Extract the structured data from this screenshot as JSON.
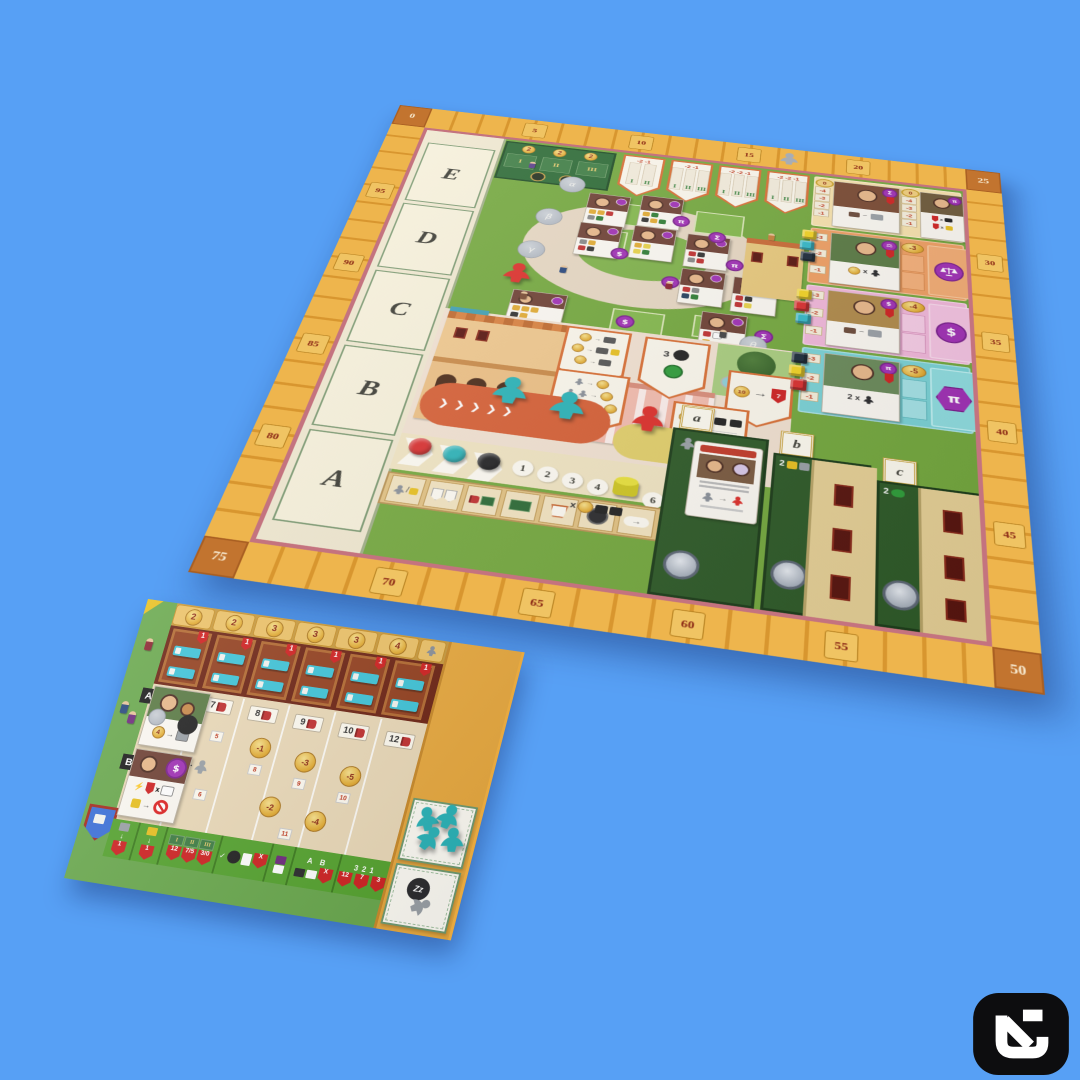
{
  "scene": {
    "background_color": "#57a0f5",
    "description": "board game tabletop product photo on blue backdrop"
  },
  "logo": {
    "icon": "un-monogram",
    "color": "#0d0d0f"
  },
  "main_board": {
    "track": {
      "corners": [
        "0",
        "25",
        "50",
        "75"
      ],
      "top": [
        "5",
        "10",
        "15",
        "20"
      ],
      "right": [
        "30",
        "35",
        "40",
        "45"
      ],
      "bottom": [
        "70",
        "65",
        "60",
        "55"
      ],
      "left": [
        "95",
        "90",
        "85",
        "80"
      ]
    },
    "book_slots": [
      "E",
      "D",
      "C",
      "B",
      "A"
    ],
    "setup_table": {
      "coins": [
        "2",
        "2",
        "2"
      ],
      "tiers": [
        "I",
        "II",
        "III"
      ]
    },
    "pennants": [
      {
        "header": "-2 -1",
        "tiers": [
          "I",
          "II"
        ]
      },
      {
        "header": "-2 -1",
        "tiers": [
          "I",
          "II",
          "III"
        ]
      },
      {
        "header": "-2 -2 -1",
        "tiers": [
          "I",
          "II",
          "III"
        ]
      },
      {
        "header": "-2 -2 -1",
        "tiers": [
          "I",
          "II",
          "III"
        ]
      }
    ],
    "spots": {
      "s0": "α",
      "s1": "β",
      "s2": "γ",
      "s3": "ε",
      "s4": "ζ",
      "s5": "η",
      "s6": "θ"
    },
    "badges": [
      "π",
      "Σ",
      "$",
      "π",
      "$",
      "π",
      "Σ"
    ],
    "town": {
      "p2_count": "3",
      "p3_coin": "10",
      "p3_flag": "7"
    },
    "prof_rows": {
      "row0": {
        "start": "0",
        "ladder": [
          "-4",
          "-3",
          "-2",
          "-1"
        ],
        "start2": "0",
        "ladder2": [
          "-4",
          "-3",
          "-2",
          "-1"
        ]
      },
      "row1": {
        "coin": "-3",
        "ladder": [
          "-3",
          "-2",
          "-1"
        ],
        "label": "x",
        "symbol": "law-scales"
      },
      "row2": {
        "coin": "-4",
        "ladder": [
          "-3",
          "-2",
          "-1"
        ],
        "symbol": "$"
      },
      "row3": {
        "coin": "-5",
        "ladder": [
          "-3",
          "-2",
          "-1"
        ],
        "label": "2 x",
        "symbol": "π"
      }
    },
    "colleges": {
      "labels": [
        "a",
        "b",
        "c"
      ],
      "count_b": "2",
      "count_c": "2"
    },
    "turn_circles": [
      "1",
      "2",
      "3",
      "4",
      "6"
    ],
    "icon_strip_x": "x",
    "piece_colors": {
      "red": "#dd2f2a",
      "teal": "#2ab3b8",
      "black": "#1d1d1f",
      "yellow": "#ddd52e",
      "navy": "#1d2b3a"
    }
  },
  "player_board": {
    "rent_tabs": [
      "2",
      "2",
      "3",
      "3",
      "3",
      "4"
    ],
    "room_flag": "1",
    "columns": [
      "6",
      "7",
      "8",
      "9",
      "10",
      "12"
    ],
    "coins_upper": [
      "-1",
      "-3",
      "-5"
    ],
    "coins_lower": [
      "-2",
      "-4"
    ],
    "cell_tags": [
      "3",
      "5",
      "8",
      "4",
      "6",
      "9",
      "10",
      "11"
    ],
    "row_labels": [
      "A",
      "B"
    ],
    "card_a_coin": "4",
    "plus_sign": "+",
    "strip": {
      "flag1": "1",
      "flag2": "1",
      "tiers": [
        "I",
        "II",
        "III"
      ],
      "grid_flags": [
        "12",
        "7/5",
        "3/0"
      ],
      "x_flag1": "X",
      "ab": [
        "A",
        "B"
      ],
      "x_flag2": "X",
      "meeple_counts": [
        "3",
        "2",
        "1"
      ],
      "count_flags": [
        "12",
        "7",
        "3"
      ]
    },
    "sleep_label": "Zz"
  }
}
